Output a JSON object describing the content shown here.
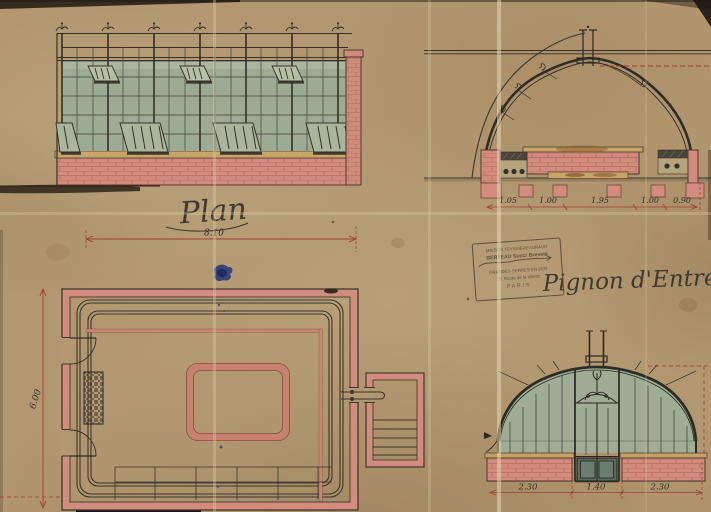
{
  "views": {
    "plan": {
      "title": "Plan",
      "width_label": "8.10",
      "height_label": "6.00"
    },
    "cross_section": {
      "dimensions": [
        "1.05",
        "1.00",
        "1.95",
        "1.00",
        "0.90"
      ]
    },
    "entrance_gable": {
      "title": "Pignon d'Entrée.",
      "dimensions": [
        "2.30",
        "1.40",
        "2.30"
      ]
    }
  },
  "stamp": {
    "lines": [
      "MAISON TEYSSIÈRE-GIRAUD",
      "BERTEAU Succr Breveté",
      "GRANDES SERRES EN FER",
      "20, Route de la Villette",
      "PARIS"
    ]
  },
  "colors": {
    "paper": "#b29770",
    "brick": "#d28b7c",
    "glass": "#9dab94",
    "ink": "#33302a",
    "dimension_red": "#9c4034",
    "ink_blue": "#2c3e7d"
  }
}
